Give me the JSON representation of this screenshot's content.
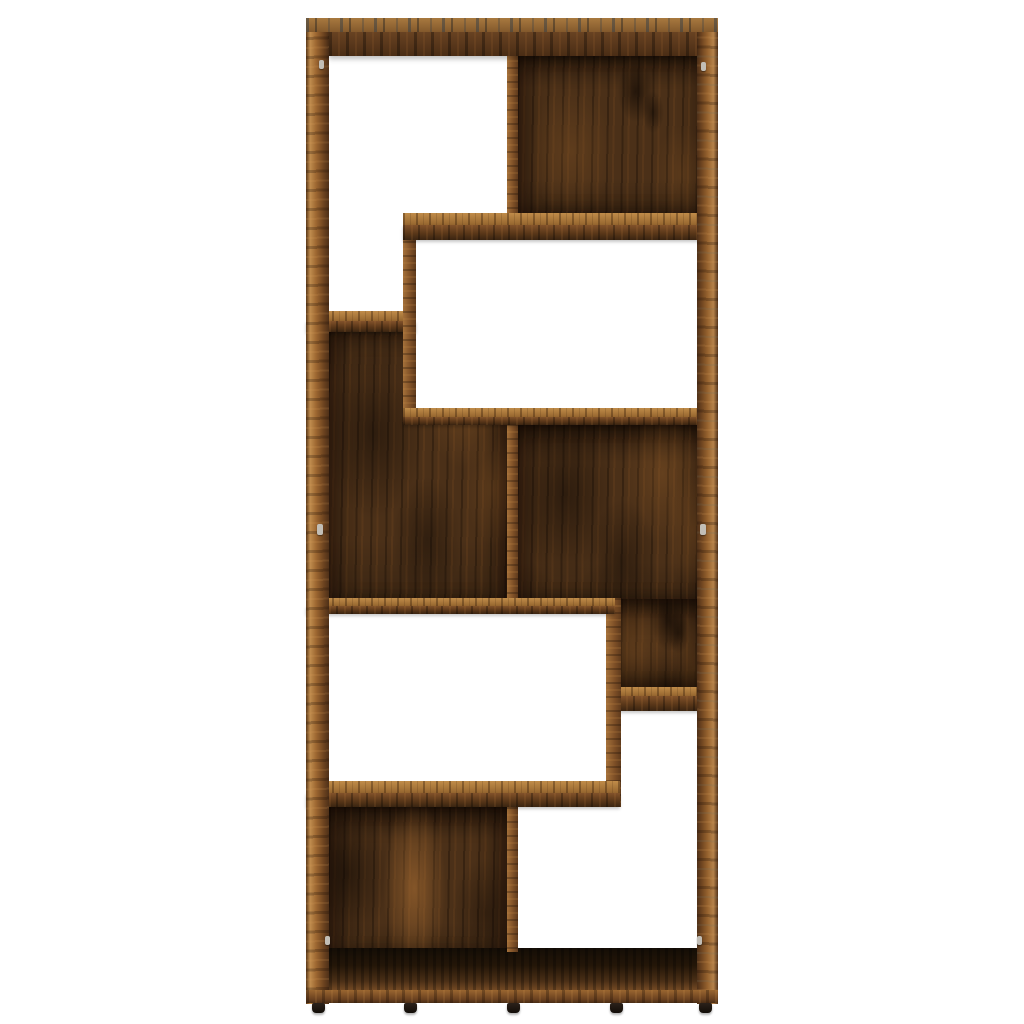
{
  "scene": {
    "alt": "Product photograph of a free-standing geometric zigzag bookcase / room divider in a smoked oak wood finish, shown front-on against a plain white background. The tall rectangular frame contains eight staggered compartments: four with dark wood-grain back panels and four open-backed showing white through, arranged in an interlocking stepped pattern, standing on five small black feet.",
    "object_label": "Bookcase / room divider",
    "finish_label": "Smoked oak wood grain",
    "background_color": "#ffffff",
    "counts": {
      "compartments": 8,
      "paneled_compartments": 4,
      "open_back_compartments": 4,
      "vertical_dividers": 5,
      "shelves": 6,
      "feet": 5,
      "shelf_pins": 6
    },
    "palette": {
      "wood_highlight": "#c08c4e",
      "wood_mid": "#8a5628",
      "wood_front_dark": "#4a2d15",
      "back_panel_base": "#4b3018",
      "back_panel_knot": "#241708",
      "smoke_streak_gray": "#39424a",
      "floor_shadow": "#140d06",
      "foot_color": "#17120c",
      "pin_metal": "#c2beb6"
    }
  }
}
